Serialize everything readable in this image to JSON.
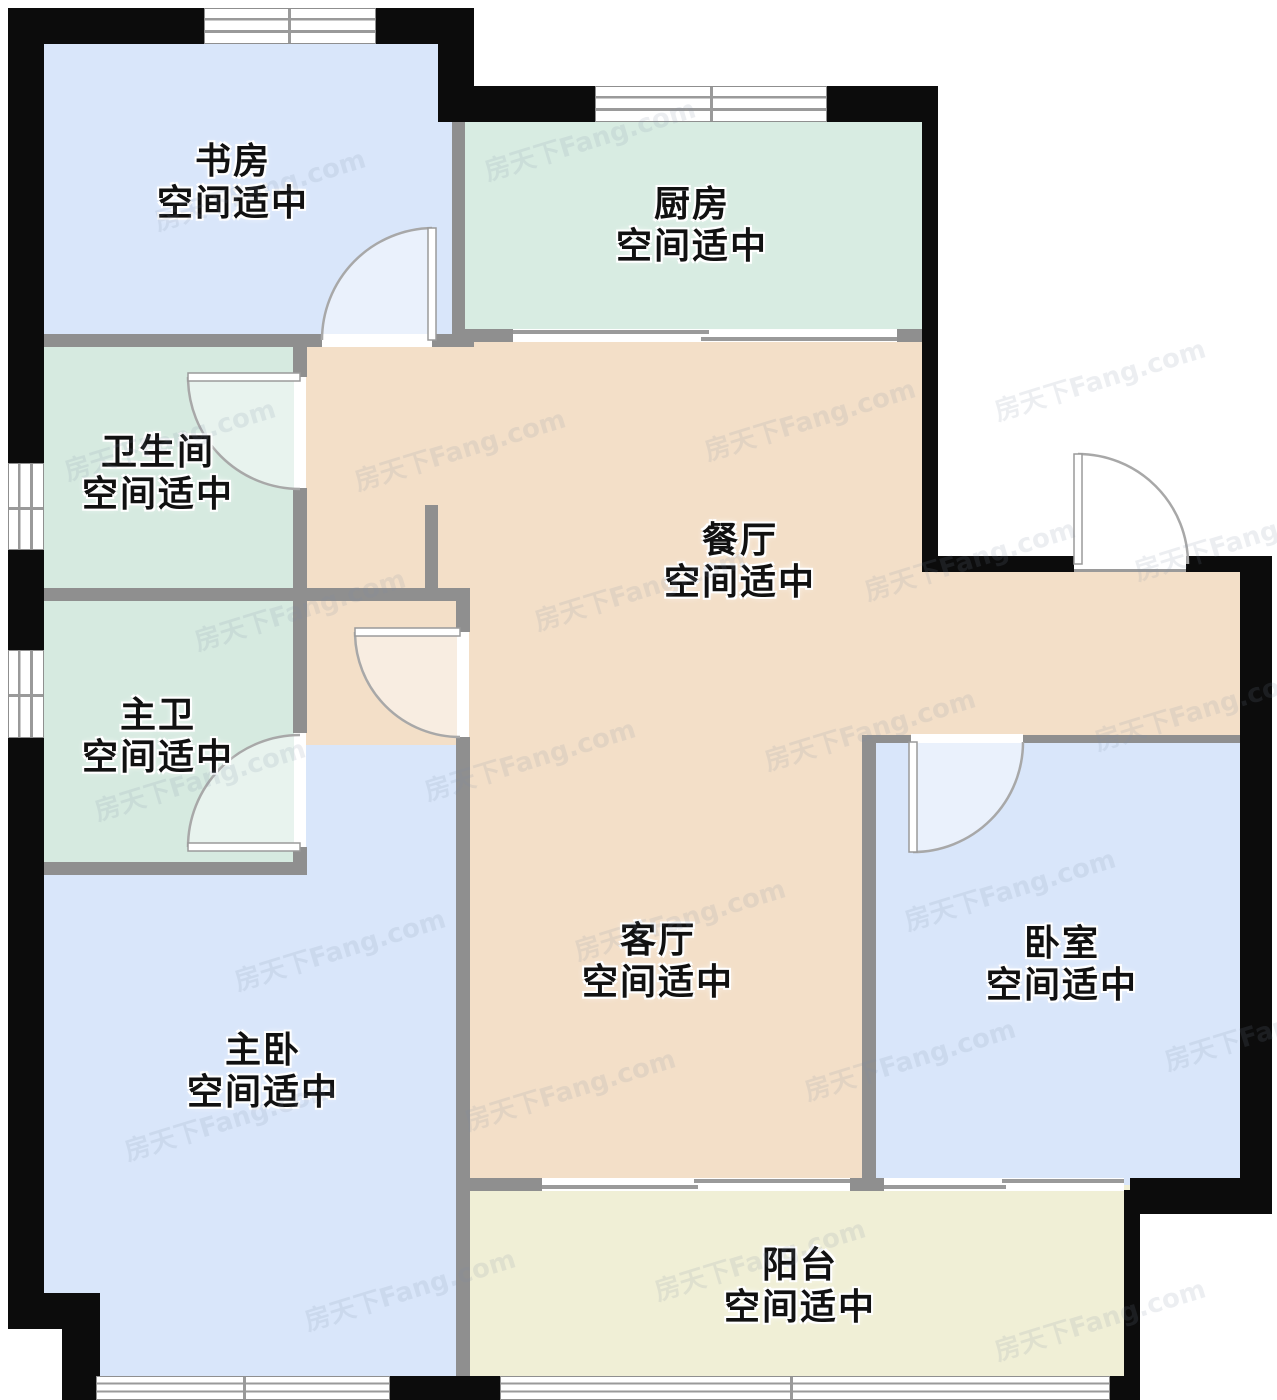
{
  "watermark": {
    "text": "房天下Fang.com"
  },
  "palette": {
    "room_blue": "#d9e6fa",
    "room_green": "#d6eae0",
    "room_beige": "#f3dfc8",
    "room_yellow": "#f0efd6",
    "outer_wall": "#0c0c0c",
    "inner_wall": "#8f8f8f",
    "door_line": "#a8a8a8",
    "label_text": "#111111"
  },
  "rooms": [
    {
      "id": "study",
      "name": "书房",
      "condition": "空间适中"
    },
    {
      "id": "kitchen",
      "name": "厨房",
      "condition": "空间适中"
    },
    {
      "id": "bathroom",
      "name": "卫生间",
      "condition": "空间适中"
    },
    {
      "id": "dining",
      "name": "餐厅",
      "condition": "空间适中"
    },
    {
      "id": "master-bathroom",
      "name": "主卫",
      "condition": "空间适中"
    },
    {
      "id": "living",
      "name": "客厅",
      "condition": "空间适中"
    },
    {
      "id": "master-bedroom",
      "name": "主卧",
      "condition": "空间适中"
    },
    {
      "id": "bedroom",
      "name": "卧室",
      "condition": "空间适中"
    },
    {
      "id": "balcony",
      "name": "阳台",
      "condition": "空间适中"
    }
  ]
}
